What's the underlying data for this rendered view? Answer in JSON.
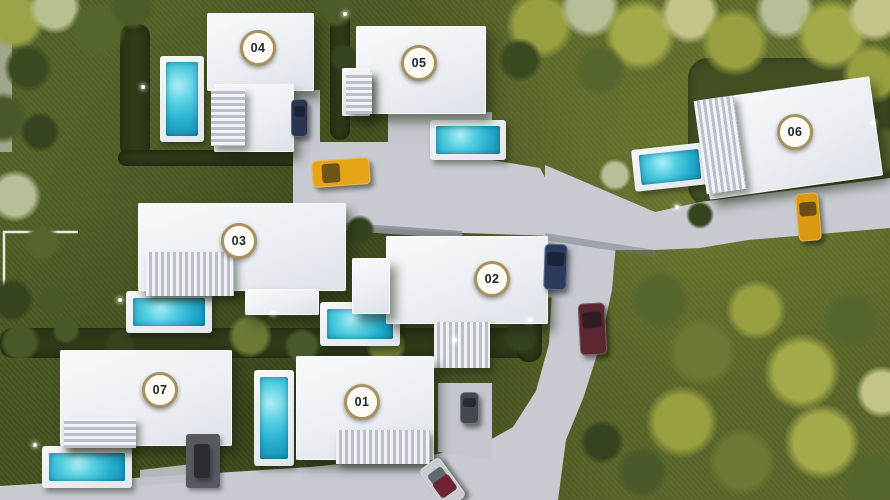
{
  "scene": {
    "name": "villa-development-aerial-masterplan",
    "canvas": {
      "width": 890,
      "height": 500
    },
    "palette": {
      "grass": "#46541f",
      "hedge": "#2e3a18",
      "plot_grass": "#3c4a22",
      "road": "#c7cad0",
      "road_wall": "#8e939b",
      "building": "#f3f5f7",
      "pool_water": "#2fb9d8",
      "pool_deck": "#eef0f2",
      "badge_bg": "#fdfbf4",
      "badge_ring": "#a8905f",
      "badge_text": "#1c2330",
      "boundary_line": "#e9e9e4"
    },
    "roads": [
      {
        "name": "plaza-road",
        "d": "M293,142 L462,142 L462,155 L540,168 L556,198 L556,236 L462,233 L366,227 L293,221 Z",
        "fill": "#c7cad0",
        "opacity": 1
      },
      {
        "name": "villa-05-driveway",
        "d": "M388,112 L492,112 L492,144 L388,144 Z",
        "fill": "#c3c6cc",
        "opacity": 1
      },
      {
        "name": "villa-04-driveway",
        "d": "M283,90 L320,90 L320,152 L283,152 Z",
        "fill": "#c3c6cc",
        "opacity": 1
      },
      {
        "name": "east-road-to-villa-06",
        "d": "M545,165 L655,212 L700,202 L745,196 L890,178 L890,228 L748,240 L700,248 L655,250 L600,250 L545,233 Z",
        "fill": "#c7cad0",
        "opacity": 1
      },
      {
        "name": "south-road",
        "d": "M543,228 L616,243 L612,290 L600,345 L584,396 L566,440 L558,500 L0,500 L0,486 L150,477 L310,467 L432,455 L481,445 L513,427 L536,391 L549,344 L552,290 L543,254 Z",
        "fill": "#c7cad0",
        "opacity": 1
      },
      {
        "name": "villa-02-driveway",
        "d": "M534,236 L578,246 L576,300 L534,296 Z",
        "fill": "#c3c6cc",
        "opacity": 1
      },
      {
        "name": "villa-01-driveway",
        "d": "M438,383 L492,383 L492,460 L438,452 Z",
        "fill": "#c3c6cc",
        "opacity": 1
      },
      {
        "name": "villa-07-path",
        "d": "M140,470 L192,464 L192,482 L140,486 Z",
        "fill": "#bfc2c8",
        "opacity": 0.9
      },
      {
        "name": "plaza-south-wall",
        "d": "M293,219 L462,231 L462,239 L293,227 Z",
        "fill": "#8e939b",
        "opacity": 0.9
      },
      {
        "name": "east-road-south-shadow",
        "d": "M545,233 L655,250 L655,257 L545,240 Z",
        "fill": "#6f747c",
        "opacity": 0.45
      },
      {
        "name": "left-edge-path",
        "d": "M0,0 L12,0 L12,152 L0,152 Z",
        "fill": "#c9cec2",
        "opacity": 0.65
      }
    ],
    "boundary_lines": [
      {
        "name": "plot-boundary-line-left",
        "points": "78,232 4,232 4,302",
        "stroke": "#e9e9e4",
        "width": 2.5
      }
    ],
    "hedges": [
      {
        "name": "hedge-villa-04-pool",
        "x": 120,
        "y": 24,
        "w": 30,
        "h": 134
      },
      {
        "name": "hedge-between-04-05",
        "x": 330,
        "y": 0,
        "w": 20,
        "h": 140
      },
      {
        "name": "hedge-below-villa-04",
        "x": 118,
        "y": 150,
        "w": 212,
        "h": 16
      },
      {
        "name": "hedge-central-band",
        "x": 0,
        "y": 328,
        "w": 540,
        "h": 30
      },
      {
        "name": "hedge-right-of-villa-02",
        "x": 516,
        "y": 296,
        "w": 26,
        "h": 66
      },
      {
        "name": "villa-06-plot-grass",
        "x": 688,
        "y": 58,
        "w": 202,
        "h": 148,
        "fill": "#3c4a22",
        "soft": true
      },
      {
        "name": "hedge-bottom-left",
        "x": 0,
        "y": 488,
        "w": 140,
        "h": 12
      }
    ],
    "trees": [
      {
        "x": 15,
        "y": 20,
        "r": 30,
        "c": "#9aa348"
      },
      {
        "x": 55,
        "y": 8,
        "r": 26,
        "c": "#b7c08f"
      },
      {
        "x": 98,
        "y": 30,
        "r": 28,
        "c": "#55662c"
      },
      {
        "x": 28,
        "y": 68,
        "r": 24,
        "c": "#3a4a20"
      },
      {
        "x": 132,
        "y": 8,
        "r": 22,
        "c": "#4c5c28"
      },
      {
        "x": 2,
        "y": 118,
        "r": 26,
        "c": "#49592a"
      },
      {
        "x": 40,
        "y": 132,
        "r": 20,
        "c": "#35431e"
      },
      {
        "x": 335,
        "y": 8,
        "r": 20,
        "c": "#4c5c28"
      },
      {
        "x": 344,
        "y": 58,
        "r": 15,
        "c": "#35431e"
      },
      {
        "x": 540,
        "y": 25,
        "r": 34,
        "c": "#98a03f"
      },
      {
        "x": 590,
        "y": 8,
        "r": 30,
        "c": "#b6bf97"
      },
      {
        "x": 640,
        "y": 35,
        "r": 36,
        "c": "#a3aa49"
      },
      {
        "x": 690,
        "y": 14,
        "r": 30,
        "c": "#c2c489"
      },
      {
        "x": 735,
        "y": 42,
        "r": 34,
        "c": "#98a03f"
      },
      {
        "x": 785,
        "y": 10,
        "r": 30,
        "c": "#b6bf97"
      },
      {
        "x": 832,
        "y": 35,
        "r": 36,
        "c": "#a3aa49"
      },
      {
        "x": 875,
        "y": 14,
        "r": 28,
        "c": "#c2c489"
      },
      {
        "x": 872,
        "y": 74,
        "r": 30,
        "c": "#98a03f"
      },
      {
        "x": 600,
        "y": 70,
        "r": 26,
        "c": "#55662c"
      },
      {
        "x": 520,
        "y": 60,
        "r": 22,
        "c": "#3a4a20"
      },
      {
        "x": 884,
        "y": 150,
        "r": 24,
        "c": "#55662c"
      },
      {
        "x": 615,
        "y": 175,
        "r": 16,
        "c": "#b6bf97"
      },
      {
        "x": 700,
        "y": 215,
        "r": 14,
        "c": "#35431e"
      },
      {
        "x": 15,
        "y": 196,
        "r": 26,
        "c": "#b6bf97"
      },
      {
        "x": 42,
        "y": 242,
        "r": 18,
        "c": "#55662c"
      },
      {
        "x": 12,
        "y": 300,
        "r": 22,
        "c": "#35431e"
      },
      {
        "x": 52,
        "y": 300,
        "r": 15,
        "c": "#49592a"
      },
      {
        "x": 20,
        "y": 342,
        "r": 20,
        "c": "#49592a"
      },
      {
        "x": 250,
        "y": 336,
        "r": 22,
        "c": "#6a7a35"
      },
      {
        "x": 302,
        "y": 346,
        "r": 18,
        "c": "#49592a"
      },
      {
        "x": 386,
        "y": 346,
        "r": 20,
        "c": "#6a7a35"
      },
      {
        "x": 456,
        "y": 350,
        "r": 16,
        "c": "#49592a"
      },
      {
        "x": 521,
        "y": 336,
        "r": 18,
        "c": "#35431e"
      },
      {
        "x": 120,
        "y": 344,
        "r": 16,
        "c": "#35431e"
      },
      {
        "x": 66,
        "y": 330,
        "r": 14,
        "c": "#49592a"
      },
      {
        "x": 360,
        "y": 230,
        "r": 15,
        "c": "#35431e"
      },
      {
        "x": 660,
        "y": 300,
        "r": 30,
        "c": "#55662c"
      },
      {
        "x": 702,
        "y": 352,
        "r": 34,
        "c": "#6a7a35"
      },
      {
        "x": 756,
        "y": 310,
        "r": 30,
        "c": "#98a03f"
      },
      {
        "x": 802,
        "y": 372,
        "r": 38,
        "c": "#a3aa49"
      },
      {
        "x": 852,
        "y": 320,
        "r": 30,
        "c": "#55662c"
      },
      {
        "x": 682,
        "y": 422,
        "r": 36,
        "c": "#98a03f"
      },
      {
        "x": 742,
        "y": 462,
        "r": 34,
        "c": "#6a7a35"
      },
      {
        "x": 822,
        "y": 442,
        "r": 38,
        "c": "#a3aa49"
      },
      {
        "x": 872,
        "y": 482,
        "r": 30,
        "c": "#55662c"
      },
      {
        "x": 642,
        "y": 472,
        "r": 26,
        "c": "#49592a"
      },
      {
        "x": 602,
        "y": 442,
        "r": 22,
        "c": "#35431e"
      },
      {
        "x": 882,
        "y": 392,
        "r": 26,
        "c": "#c2c489"
      }
    ],
    "villas": [
      {
        "id": "villa-04",
        "label": "04",
        "badge": {
          "x": 258,
          "y": 48
        },
        "building": {
          "parts": [
            {
              "x": 207,
              "y": 13,
              "w": 107,
              "h": 78
            },
            {
              "x": 214,
              "y": 84,
              "w": 80,
              "h": 68
            }
          ],
          "pergolas": [
            {
              "x": 211,
              "y": 88,
              "w": 34,
              "h": 58,
              "dir": "h"
            }
          ]
        },
        "pool": {
          "deck": {
            "x": 160,
            "y": 56,
            "w": 44,
            "h": 86
          },
          "water": {
            "x": 166,
            "y": 62,
            "w": 32,
            "h": 74
          }
        }
      },
      {
        "id": "villa-05",
        "label": "05",
        "badge": {
          "x": 419,
          "y": 63
        },
        "building": {
          "parts": [
            {
              "x": 356,
              "y": 26,
              "w": 130,
              "h": 88
            },
            {
              "x": 342,
              "y": 68,
              "w": 28,
              "h": 48
            }
          ],
          "pergolas": [
            {
              "x": 346,
              "y": 72,
              "w": 26,
              "h": 42,
              "dir": "h"
            }
          ]
        },
        "pool": {
          "deck": {
            "x": 430,
            "y": 120,
            "w": 76,
            "h": 40
          },
          "water": {
            "x": 436,
            "y": 126,
            "w": 64,
            "h": 28
          }
        }
      },
      {
        "id": "villa-06",
        "label": "06",
        "badge": {
          "x": 795,
          "y": 132
        },
        "building": {
          "parts": [
            {
              "x": 702,
              "y": 88,
              "w": 175,
              "h": 100,
              "rot": -8
            }
          ],
          "pergolas": [
            {
              "x": 700,
              "y": 98,
              "w": 40,
              "h": 94,
              "dir": "v",
              "rot": -8
            }
          ]
        },
        "pool": {
          "deck": {
            "x": 633,
            "y": 146,
            "w": 74,
            "h": 42,
            "rot": -6
          },
          "water": {
            "x": 640,
            "y": 152,
            "w": 60,
            "h": 30,
            "rot": -6
          }
        }
      },
      {
        "id": "villa-03",
        "label": "03",
        "badge": {
          "x": 239,
          "y": 241
        },
        "building": {
          "parts": [
            {
              "x": 138,
              "y": 203,
              "w": 208,
              "h": 88
            },
            {
              "x": 245,
              "y": 289,
              "w": 74,
              "h": 26
            }
          ],
          "pergolas": [
            {
              "x": 146,
              "y": 252,
              "w": 88,
              "h": 44,
              "dir": "v"
            }
          ]
        },
        "pool": {
          "deck": {
            "x": 126,
            "y": 291,
            "w": 86,
            "h": 42
          },
          "water": {
            "x": 133,
            "y": 298,
            "w": 72,
            "h": 28
          }
        }
      },
      {
        "id": "villa-02",
        "label": "02",
        "badge": {
          "x": 492,
          "y": 279
        },
        "building": {
          "parts": [
            {
              "x": 386,
              "y": 236,
              "w": 162,
              "h": 88
            },
            {
              "x": 352,
              "y": 258,
              "w": 38,
              "h": 56
            }
          ],
          "pergolas": [
            {
              "x": 434,
              "y": 322,
              "w": 56,
              "h": 46,
              "dir": "v"
            }
          ]
        },
        "pool": {
          "deck": {
            "x": 320,
            "y": 302,
            "w": 80,
            "h": 44
          },
          "water": {
            "x": 327,
            "y": 309,
            "w": 66,
            "h": 30
          }
        }
      },
      {
        "id": "villa-07",
        "label": "07",
        "badge": {
          "x": 160,
          "y": 390
        },
        "building": {
          "parts": [
            {
              "x": 60,
              "y": 350,
              "w": 172,
              "h": 96
            }
          ],
          "pergolas": [
            {
              "x": 64,
              "y": 418,
              "w": 72,
              "h": 30,
              "dir": "h"
            }
          ]
        },
        "pool": {
          "deck": {
            "x": 42,
            "y": 446,
            "w": 90,
            "h": 42
          },
          "water": {
            "x": 49,
            "y": 453,
            "w": 76,
            "h": 28
          }
        },
        "extras": [
          {
            "name": "dark-patio-deck",
            "x": 186,
            "y": 434,
            "w": 34,
            "h": 54,
            "fill": "#565a60"
          },
          {
            "name": "patio-furniture",
            "x": 194,
            "y": 444,
            "w": 16,
            "h": 34,
            "fill": "#2b2d30"
          }
        ]
      },
      {
        "id": "villa-01",
        "label": "01",
        "badge": {
          "x": 362,
          "y": 402
        },
        "building": {
          "parts": [
            {
              "x": 296,
              "y": 356,
              "w": 138,
              "h": 104
            }
          ],
          "pergolas": [
            {
              "x": 336,
              "y": 430,
              "w": 94,
              "h": 34,
              "dir": "v"
            }
          ]
        },
        "pool": {
          "deck": {
            "x": 254,
            "y": 370,
            "w": 40,
            "h": 96
          },
          "water": {
            "x": 260,
            "y": 377,
            "w": 28,
            "h": 82
          }
        }
      }
    ],
    "cars": [
      {
        "name": "gold-car-plaza",
        "x": 312,
        "y": 159,
        "w": 58,
        "h": 27,
        "rot": -4,
        "body": "#e6a417"
      },
      {
        "name": "navy-car-villa-04-driveway",
        "x": 291,
        "y": 99,
        "w": 17,
        "h": 38,
        "rot": 0,
        "body": "#2a3550"
      },
      {
        "name": "navy-car-villa-02-driveway",
        "x": 544,
        "y": 244,
        "w": 23,
        "h": 46,
        "rot": 2,
        "body": "#2c3a5e"
      },
      {
        "name": "maroon-car-south-road",
        "x": 579,
        "y": 303,
        "w": 27,
        "h": 52,
        "rot": -3,
        "body": "#5a2730"
      },
      {
        "name": "gold-car-villa-06-driveway",
        "x": 797,
        "y": 193,
        "w": 23,
        "h": 48,
        "rot": -5,
        "body": "#d99a12"
      },
      {
        "name": "grey-car-villa-01-driveway",
        "x": 460,
        "y": 392,
        "w": 19,
        "h": 32,
        "rot": 0,
        "body": "#44484f"
      },
      {
        "name": "silver-car-south-road",
        "x": 430,
        "y": 459,
        "w": 25,
        "h": 48,
        "rot": -36,
        "body": "#c9ccd0",
        "roof": "#6e2430"
      }
    ],
    "garden_lights": [
      {
        "x": 143,
        "y": 87
      },
      {
        "x": 345,
        "y": 14
      },
      {
        "x": 873,
        "y": 123
      },
      {
        "x": 677,
        "y": 207
      },
      {
        "x": 273,
        "y": 313
      },
      {
        "x": 455,
        "y": 340
      },
      {
        "x": 120,
        "y": 300
      },
      {
        "x": 35,
        "y": 445
      },
      {
        "x": 530,
        "y": 320
      }
    ]
  }
}
